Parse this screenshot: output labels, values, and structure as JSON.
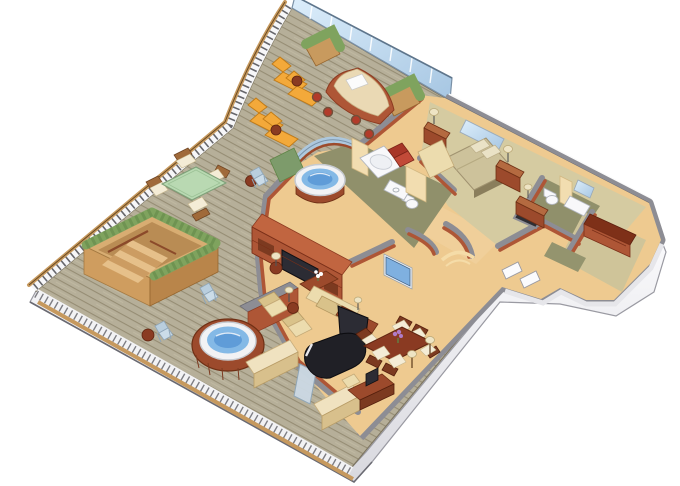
{
  "image_type": "isometric-3d-floor-plan-illustration",
  "subject": "luxury-penthouse-suite-with-wraparound-veranda",
  "palette": {
    "background": "#ffffff",
    "deck_base": "#b6af99",
    "deck_line": "#968d74",
    "rail_wood": "#c6995e",
    "rail_dark": "#4c4c52",
    "hull_white": "#f2f2f5",
    "outline": "#5a5a62",
    "glass_light": "#ddeefb",
    "glass_mid": "#a6c6e2",
    "glass_post": "#7a92a8",
    "wall_top": "#8d8d94",
    "wall_face": "#ae5636",
    "wall_face_light": "#c16540",
    "wall_face_dark": "#8f4228",
    "floor_living": "#eeca90",
    "floor_corridor": "#f0cf9a",
    "floor_bedroom": "#d5cba1",
    "floor_bath": "#90906b",
    "floor_closet": "#cfc499",
    "partition_beige": "#f2ddb0",
    "water_blue": "#84b9e6",
    "water_blue_dark": "#5f9cd8",
    "tub_white": "#f2f2f4",
    "plant_green": "#7fa35e",
    "plant_green_dark": "#5f8446",
    "lounger_orange": "#f3a93a",
    "chair_blue": "#b9cede",
    "wood_red": "#9c4a2c",
    "upholstery_beige": "#ecdcae",
    "upholstery_beige_dark": "#d9c28a",
    "accent_red": "#b23b2a",
    "piano_black": "#202026",
    "glass_table_green": "#b9d9b2",
    "runner_blue": "#3a6fc4",
    "flower_purple": "#b07cc8",
    "flower_white": "#ffffff",
    "screen_dark": "#2c2c34",
    "screen_blue": "#7fb0e0",
    "stair_tan": "#d8ad72",
    "stair_tan_dark": "#b9854a"
  },
  "scene": {
    "deck": {
      "name": "wraparound-teak-veranda",
      "objects": [
        "glass-windbreak",
        "curved-wood-railing",
        "planter-boxes",
        "sun-loungers",
        "cocktail-tables",
        "outdoor-bar",
        "bar-stools",
        "outdoor-dining-table",
        "outdoor-dining-chairs",
        "folding-deck-chairs",
        "private-stairwell-with-hedge",
        "deck-hot-tub",
        "privacy-wall",
        "storage-benches",
        "exercise-mat"
      ],
      "counts": {
        "sun_loungers": 4,
        "bar_stools": 4,
        "folding_deck_chairs": 3,
        "outdoor_dining_chairs": 4,
        "planter_boxes": 2,
        "hot_tubs": 1
      }
    },
    "interior": {
      "rooms": [
        {
          "name": "master-bedroom",
          "objects": [
            "bed",
            "pillows",
            "headboard-mirror",
            "nightstand-left",
            "nightstand-right",
            "bedside-lamps",
            "red-armchair",
            "chaise-bench",
            "dresser"
          ]
        },
        {
          "name": "master-bathroom",
          "objects": [
            "round-jacuzzi-in-glass-bay",
            "bathtub",
            "toilet",
            "vanity-sink",
            "beige-partition"
          ]
        },
        {
          "name": "guest-bathroom",
          "objects": [
            "toilet",
            "dark-shower",
            "vanity-sink",
            "mirror",
            "beige-partition"
          ]
        },
        {
          "name": "living-room",
          "objects": [
            "entertainment-center",
            "built-in-tv",
            "wall-mounted-tv",
            "sofa",
            "console-table-with-blue-runner",
            "armchairs",
            "coffee-table-white-flowers",
            "round-side-tables",
            "floor-lamp",
            "grand-piano",
            "sliding-glass-door"
          ]
        },
        {
          "name": "dining-area",
          "objects": [
            "dining-table",
            "dining-chairs",
            "purple-flower-centerpiece",
            "writing-desk",
            "desk-monitor",
            "desk-chair",
            "floor-lamps"
          ]
        },
        {
          "name": "entry-foyer",
          "objects": [
            "curved-walls",
            "white-door-panels",
            "floor-arc-inlay"
          ]
        },
        {
          "name": "walk-in-closet",
          "objects": [
            "built-in-counter",
            "shelving"
          ]
        }
      ],
      "counts": {
        "indoor_dining_chairs": 6,
        "living_armchairs": 2,
        "toilets": 2,
        "televisions": 2
      }
    }
  }
}
